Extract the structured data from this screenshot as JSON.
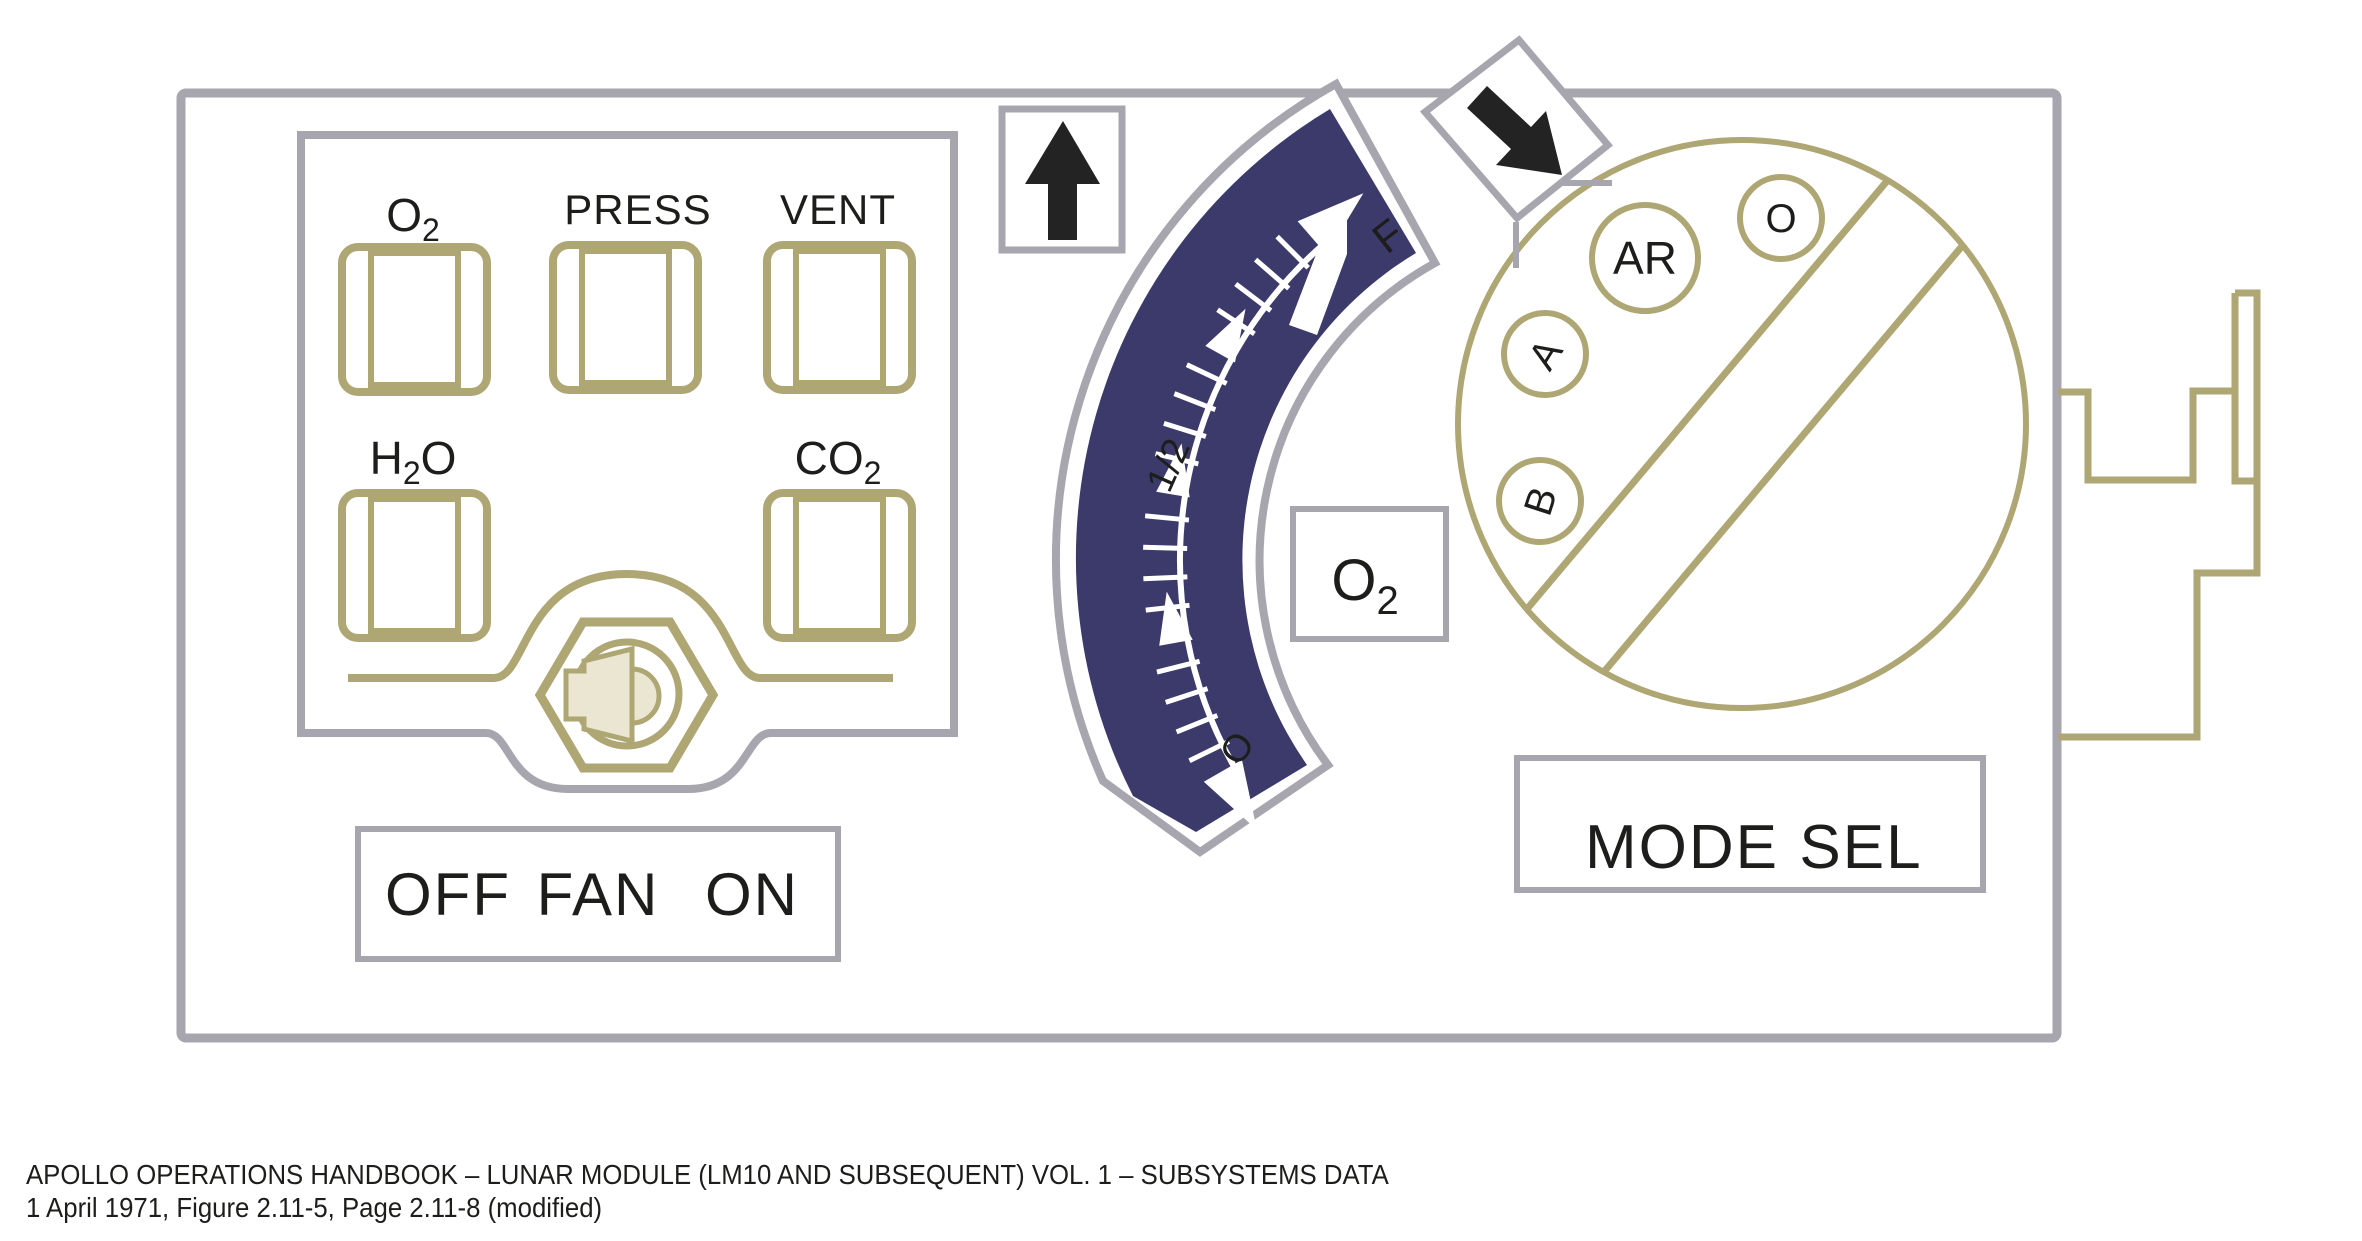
{
  "colors": {
    "panel_border": "#a7a6ae",
    "olive": "#aea673",
    "navy": "#3b3a6b",
    "text": "#1d1d1b",
    "beige": "#eae6d2",
    "white": "#ffffff",
    "arrow_black": "#232323"
  },
  "status_panel": {
    "labels": [
      {
        "id": "o2",
        "pre": "O",
        "sub": "2",
        "post": ""
      },
      {
        "id": "press",
        "pre": "PRESS",
        "sub": "",
        "post": ""
      },
      {
        "id": "vent",
        "pre": "VENT",
        "sub": "",
        "post": ""
      },
      {
        "id": "h2o",
        "pre": "H",
        "sub": "2",
        "post": "O"
      },
      {
        "id": "co2",
        "pre": "CO",
        "sub": "2",
        "post": ""
      }
    ]
  },
  "fan_switch": {
    "off_label": "OFF",
    "fan_label": "FAN",
    "on_label": "ON"
  },
  "gauge": {
    "name_pre": "O",
    "name_sub": "2",
    "full_label": "F",
    "half_label": "1/2",
    "empty_label": "O",
    "needle_fraction": 0.93,
    "major_marks": [
      0,
      0.25,
      0.5,
      0.75,
      1
    ],
    "minor_step": 0.05
  },
  "mode_selector": {
    "position_ar": "AR",
    "position_o": "O",
    "position_a": "A",
    "position_b": "B",
    "label_mode": "MODE",
    "label_sel": "SEL"
  },
  "caption": {
    "line1": "APOLLO OPERATIONS HANDBOOK – LUNAR MODULE (LM10 AND SUBSEQUENT) VOL. 1 – SUBSYSTEMS DATA",
    "line2": "1 April 1971, Figure 2.11-5, Page 2.11-8 (modified)"
  }
}
